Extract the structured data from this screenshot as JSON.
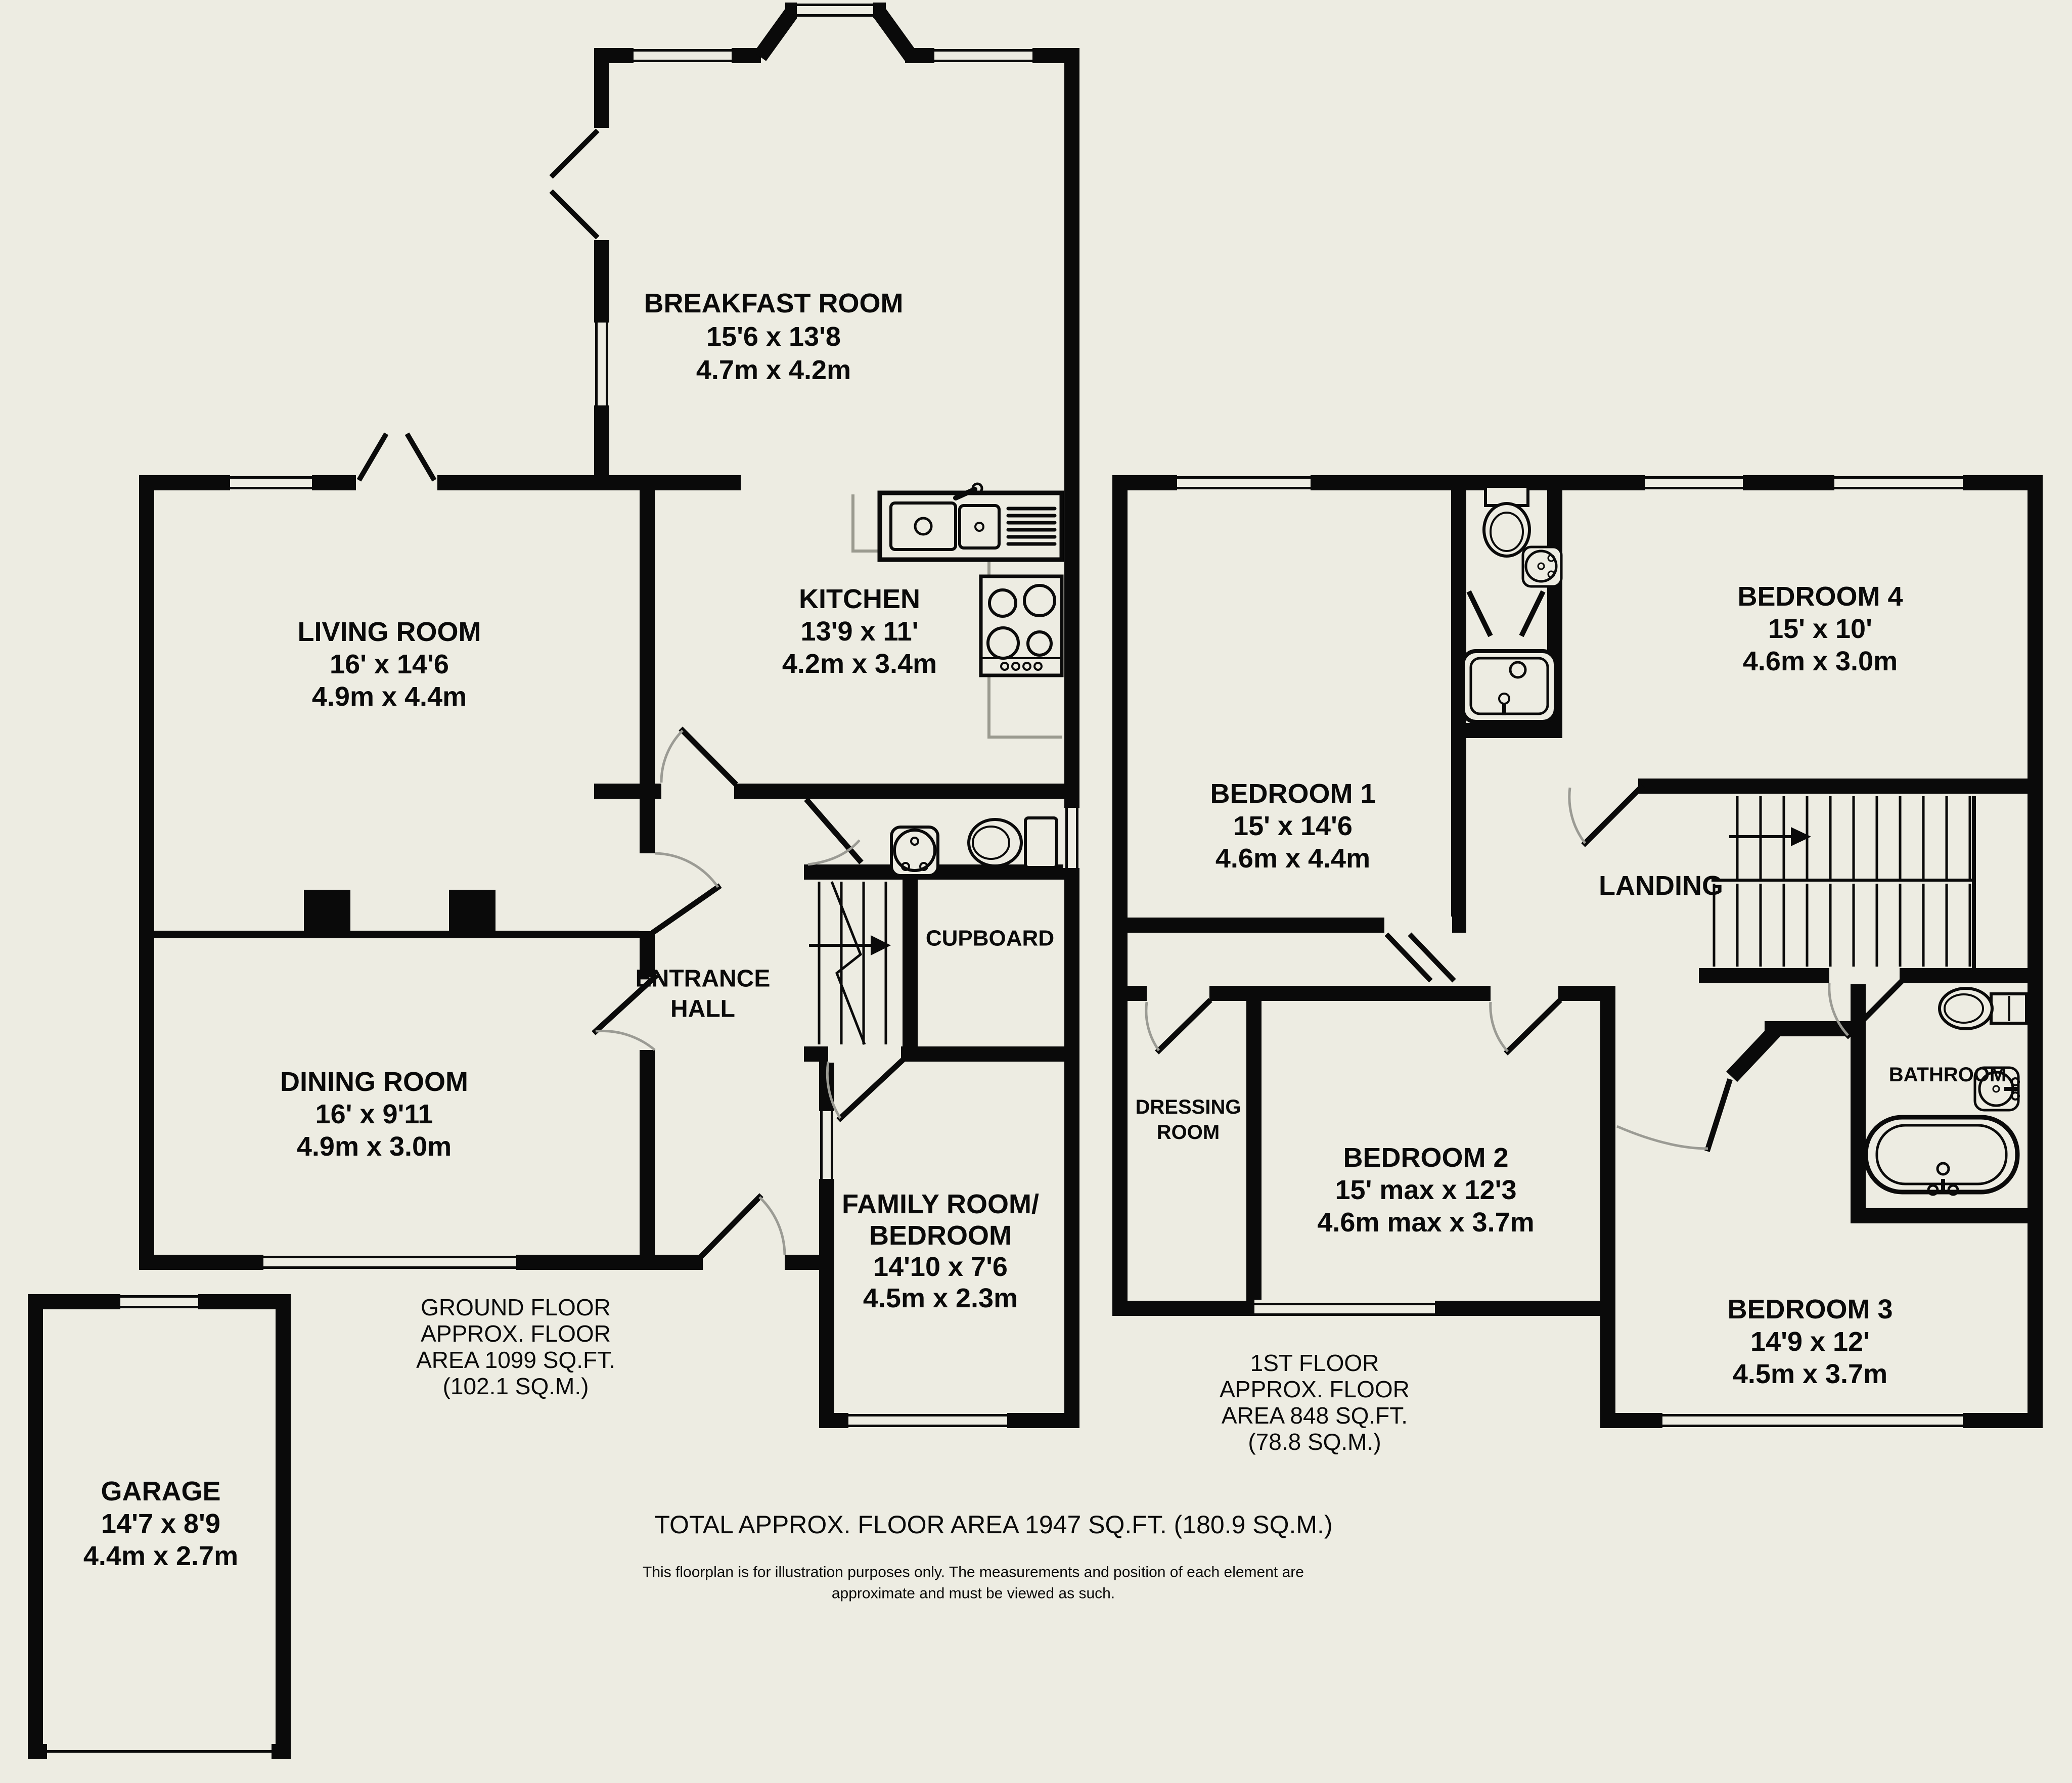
{
  "colors": {
    "background": "#edece2",
    "wall": "#0a0a0a",
    "door_arc": "#9b9b94",
    "worktop_line": "#9a9a8f"
  },
  "ground_floor": {
    "rooms": {
      "breakfast": {
        "name": "BREAKFAST ROOM",
        "imperial": "15'6 x 13'8",
        "metric": "4.7m x 4.2m"
      },
      "living": {
        "name": "LIVING ROOM",
        "imperial": "16' x 14'6",
        "metric": "4.9m x 4.4m"
      },
      "kitchen": {
        "name": "KITCHEN",
        "imperial": "13'9 x 11'",
        "metric": "4.2m x 3.4m"
      },
      "dining": {
        "name": "DINING ROOM",
        "imperial": "16' x 9'11",
        "metric": "4.9m x 3.0m"
      },
      "entrance_hall": {
        "line1": "ENTRANCE",
        "line2": "HALL"
      },
      "cupboard": {
        "name": "CUPBOARD"
      },
      "family": {
        "line1": "FAMILY ROOM/",
        "line2": "BEDROOM",
        "imperial": "14'10 x 7'6",
        "metric": "4.5m x 2.3m"
      },
      "garage": {
        "name": "GARAGE",
        "imperial": "14'7 x 8'9",
        "metric": "4.4m x 2.7m"
      }
    },
    "area_note": {
      "line1": "GROUND FLOOR",
      "line2": "APPROX. FLOOR",
      "line3": "AREA 1099 SQ.FT.",
      "line4": "(102.1 SQ.M.)"
    }
  },
  "first_floor": {
    "rooms": {
      "bedroom1": {
        "name": "BEDROOM 1",
        "imperial": "15' x 14'6",
        "metric": "4.6m x 4.4m"
      },
      "bedroom2": {
        "name": "BEDROOM 2",
        "imperial": "15' max x 12'3",
        "metric": "4.6m max x 3.7m"
      },
      "bedroom3": {
        "name": "BEDROOM 3",
        "imperial": "14'9 x 12'",
        "metric": "4.5m x 3.7m"
      },
      "bedroom4": {
        "name": "BEDROOM 4",
        "imperial": "15' x 10'",
        "metric": "4.6m x 3.0m"
      },
      "landing": {
        "name": "LANDING"
      },
      "dressing": {
        "line1": "DRESSING",
        "line2": "ROOM"
      },
      "bathroom": {
        "name": "BATHROOM"
      }
    },
    "area_note": {
      "line1": "1ST FLOOR",
      "line2": "APPROX. FLOOR",
      "line3": "AREA 848 SQ.FT.",
      "line4": "(78.8 SQ.M.)"
    }
  },
  "footer": {
    "total": "TOTAL APPROX. FLOOR AREA 1947 SQ.FT. (180.9 SQ.M.)",
    "disclaimer_line1": "This floorplan is for illustration purposes only. The measurements and position of each element are",
    "disclaimer_line2": "approximate and must be viewed as such."
  }
}
